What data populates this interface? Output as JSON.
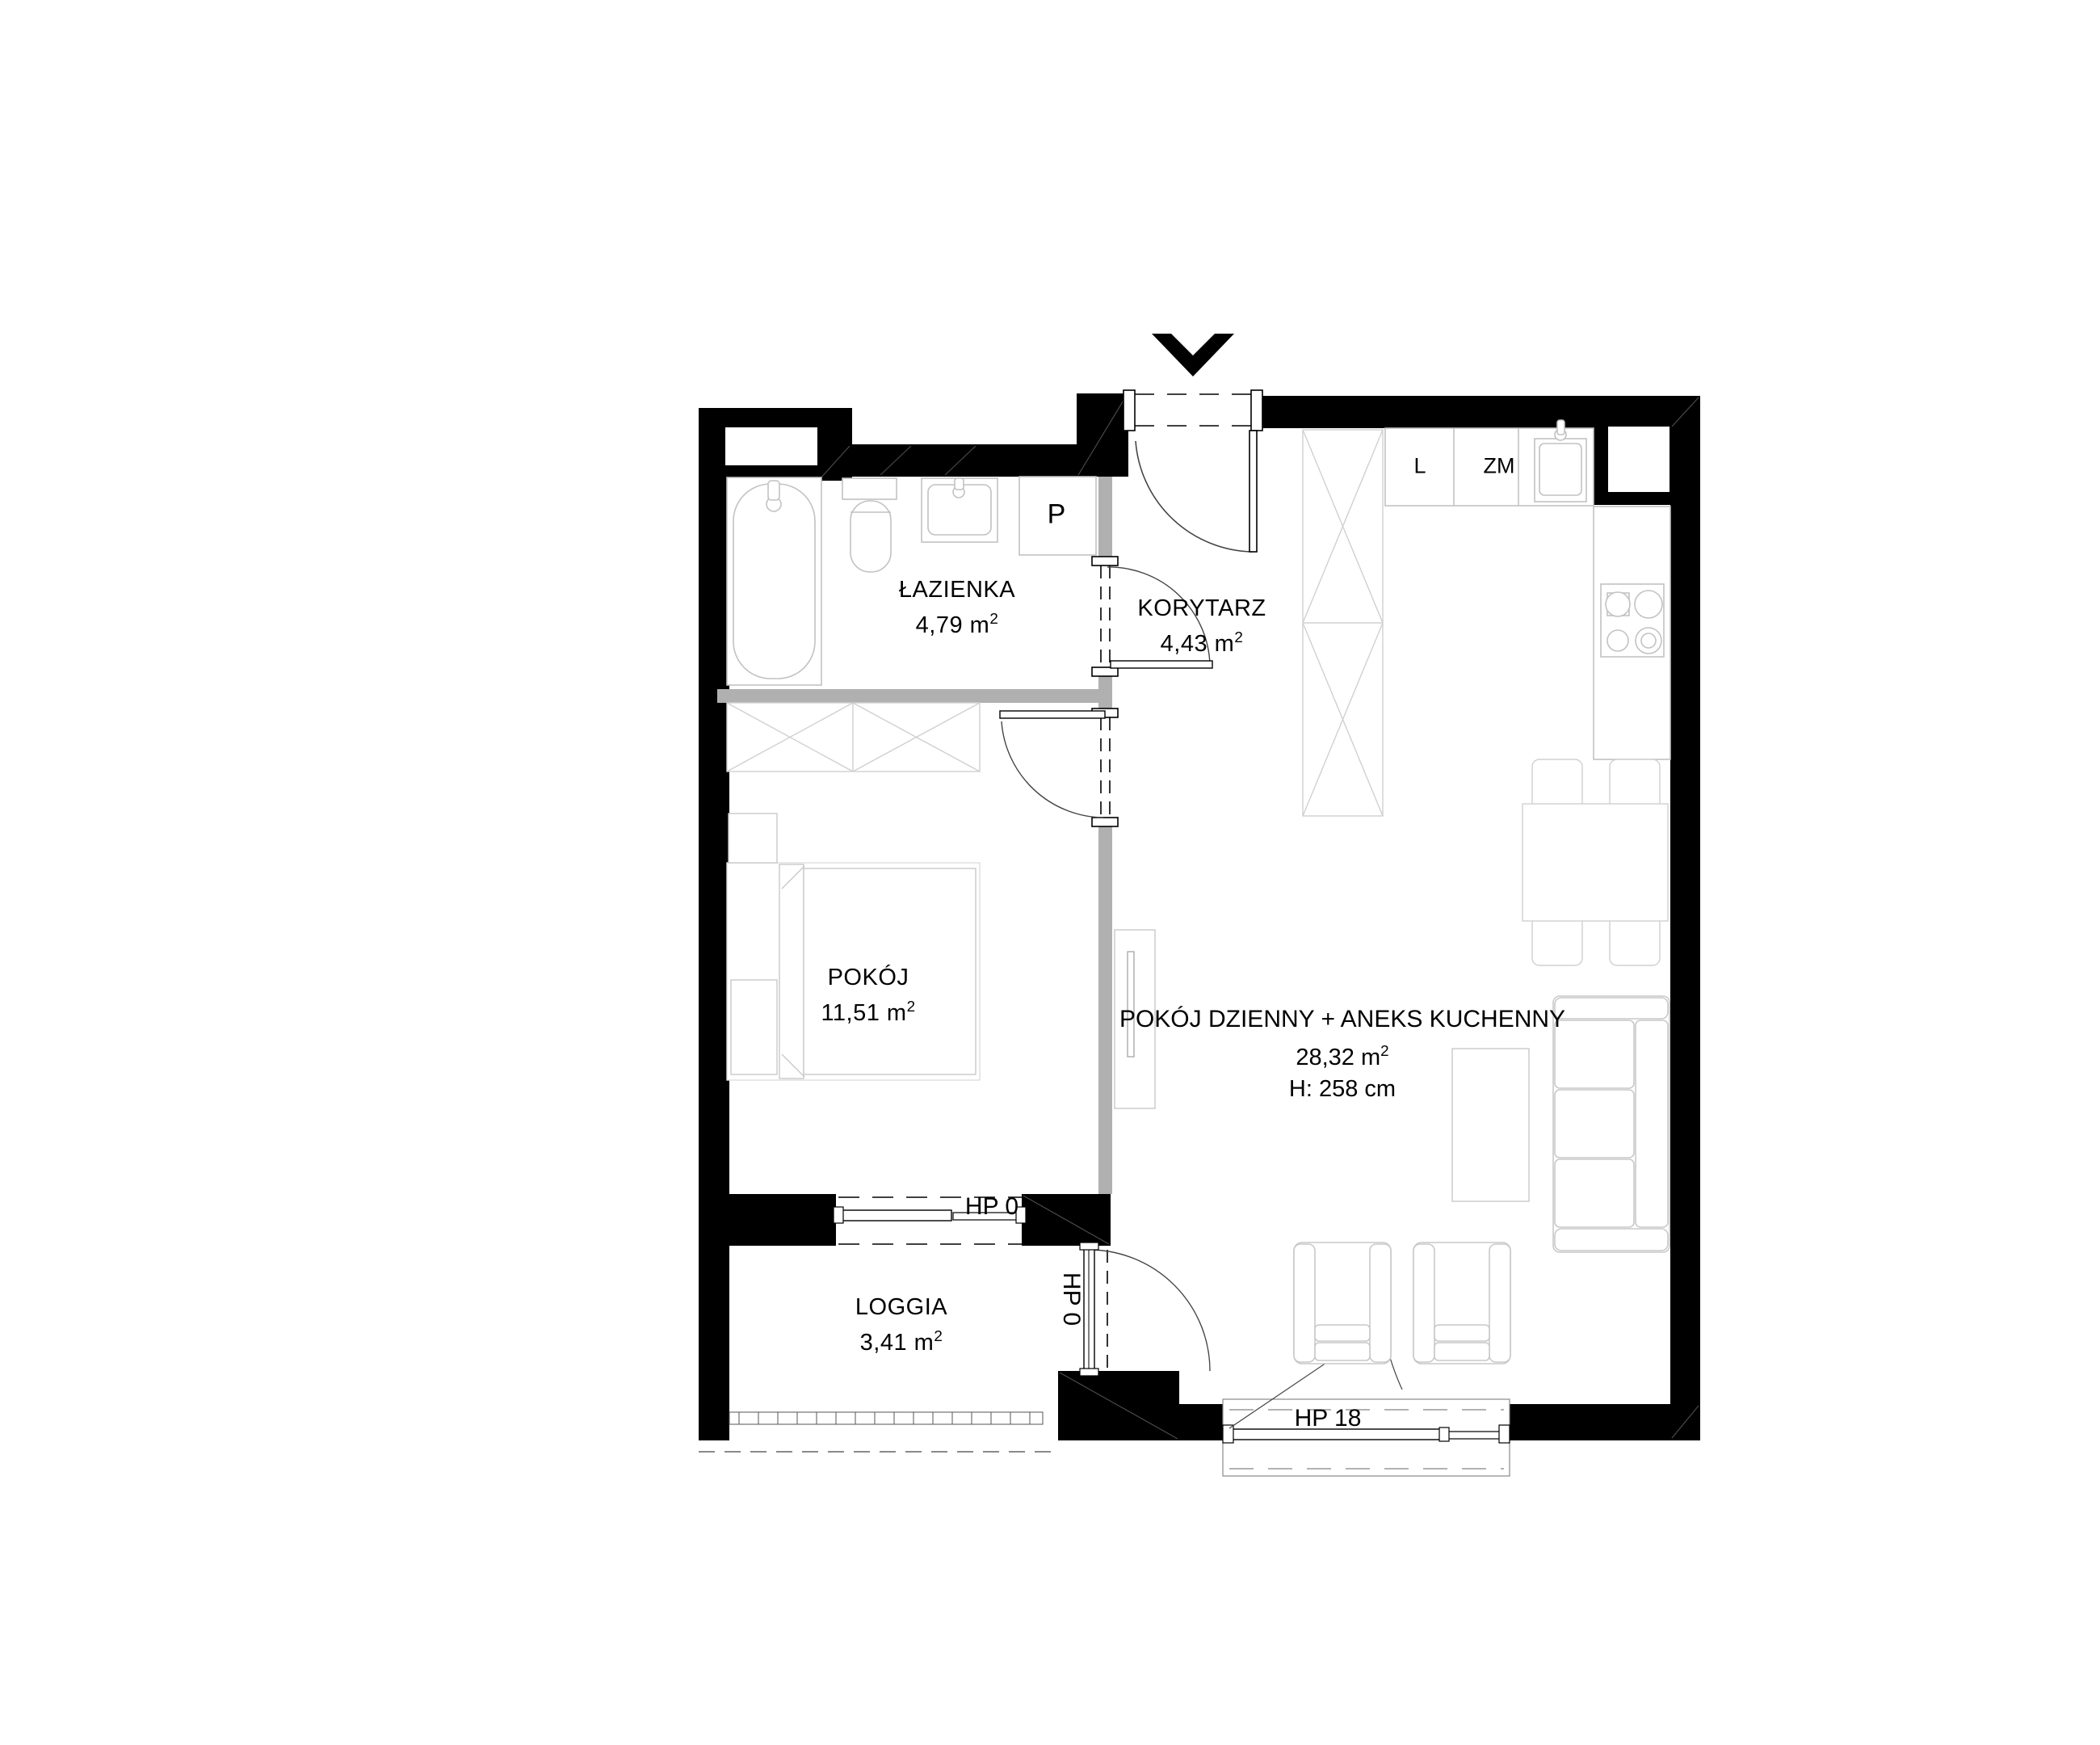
{
  "rooms": {
    "lazienka": {
      "name": "ŁAZIENKA",
      "area": "4,79 m",
      "sup": "2"
    },
    "korytarz": {
      "name": "KORYTARZ",
      "area": "4,43 m",
      "sup": "2"
    },
    "pokoj": {
      "name": "POKÓJ",
      "area": "11,51 m",
      "sup": "2"
    },
    "salon": {
      "name": "POKÓJ DZIENNY + ANEKS KUCHENNY",
      "area": "28,32 m",
      "sup": "2",
      "height_label": "H: 258 cm"
    },
    "loggia": {
      "name": "LOGGIA",
      "area": "3,41 m",
      "sup": "2"
    }
  },
  "windows": {
    "pokoj_loggia_window": "HP 0",
    "loggia_door": "HP 0",
    "salon_window": "HP 18"
  },
  "appliances": {
    "washing_machine": "P",
    "fridge": "L",
    "dishwasher": "ZM"
  },
  "icons": {
    "entrance": "entrance-arrow"
  },
  "colors": {
    "wall": "#000000",
    "partition": "#b0b0b0",
    "furniture_line": "#cccccc",
    "fixture_line": "#c2c2c2",
    "door_line": "#444444",
    "background": "#ffffff"
  }
}
